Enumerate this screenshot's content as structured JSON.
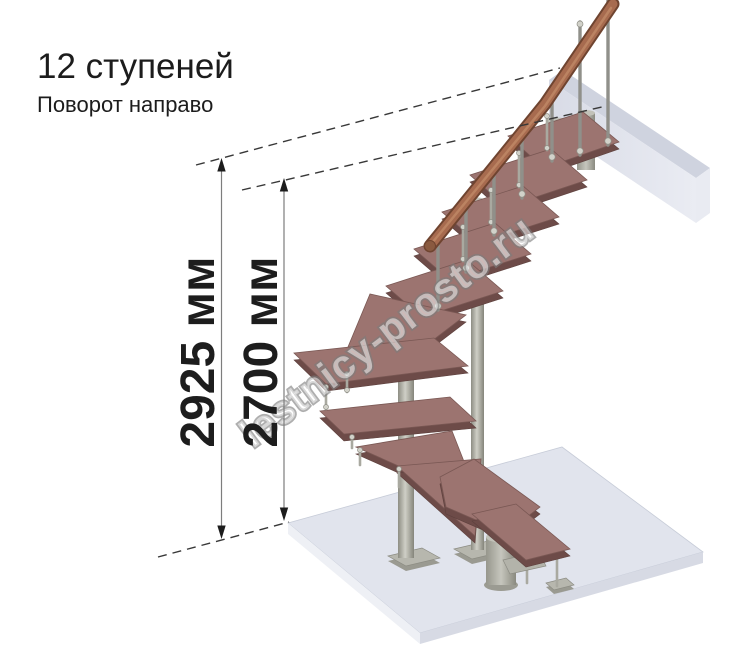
{
  "header": {
    "title": "12 ступеней",
    "subtitle": "Поворот направо"
  },
  "dimensions": {
    "overall": {
      "label": "2925 мм"
    },
    "inner": {
      "label": "2700 мм"
    }
  },
  "watermark": {
    "text": "lestnicy-prosto.ru"
  },
  "staircase": {
    "steps": 12,
    "turn": "направо",
    "tread_count_visible": 12
  },
  "colors": {
    "tread_top": "#9c7470",
    "tread_side": "#6d4b48",
    "handrail": "#a76b4f",
    "handrail_outline": "#6f4430",
    "metal": "#b2b2a9",
    "floor_top": "#e1e4ed",
    "floor_left": "#eef0f5",
    "floor_right": "#d7dae4",
    "landing": "#dde0ea",
    "text": "#1d1d1d",
    "watermark_outline": "#8e8e8e",
    "background": "#ffffff"
  }
}
